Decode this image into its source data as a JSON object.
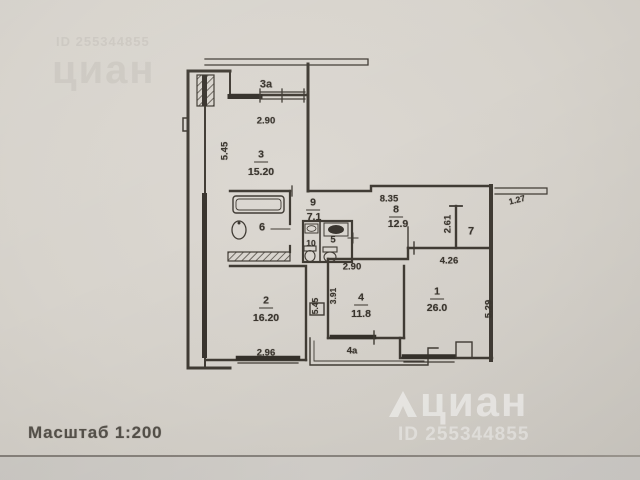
{
  "scale_label": "Масштаб 1:200",
  "watermark": {
    "brand": "циан",
    "listing_id": "ID 255344855"
  },
  "floorplan": {
    "balconies": {
      "top": "3а",
      "bottom": "4а"
    },
    "rooms": {
      "r1": {
        "num": "1",
        "area": "26.0"
      },
      "r2": {
        "num": "2",
        "area": "16.20"
      },
      "r3": {
        "num": "3",
        "area": "15.20"
      },
      "r4": {
        "num": "4",
        "area": "11.8"
      },
      "r5": {
        "num": "5"
      },
      "r6": {
        "num": "6"
      },
      "r7": {
        "num": "7"
      },
      "r8": {
        "num": "8",
        "area": "12.9"
      },
      "r9": {
        "num": "9",
        "area": "7.1"
      },
      "r10": {
        "num": "10"
      }
    },
    "dimensions": {
      "room3_width": "2.90",
      "room3_height": "5.45",
      "hall_width": "8.35",
      "wall_mid": "2.61",
      "niche_top_right": "1.27",
      "room4_width": "2.90",
      "room1_width": "4.26",
      "room2_height": "5.45",
      "room4_height": "3.91",
      "room2_width": "2.96",
      "room1_height": "5.29"
    },
    "line_color": "#413c35",
    "paper_color": "#d7d3cc"
  }
}
